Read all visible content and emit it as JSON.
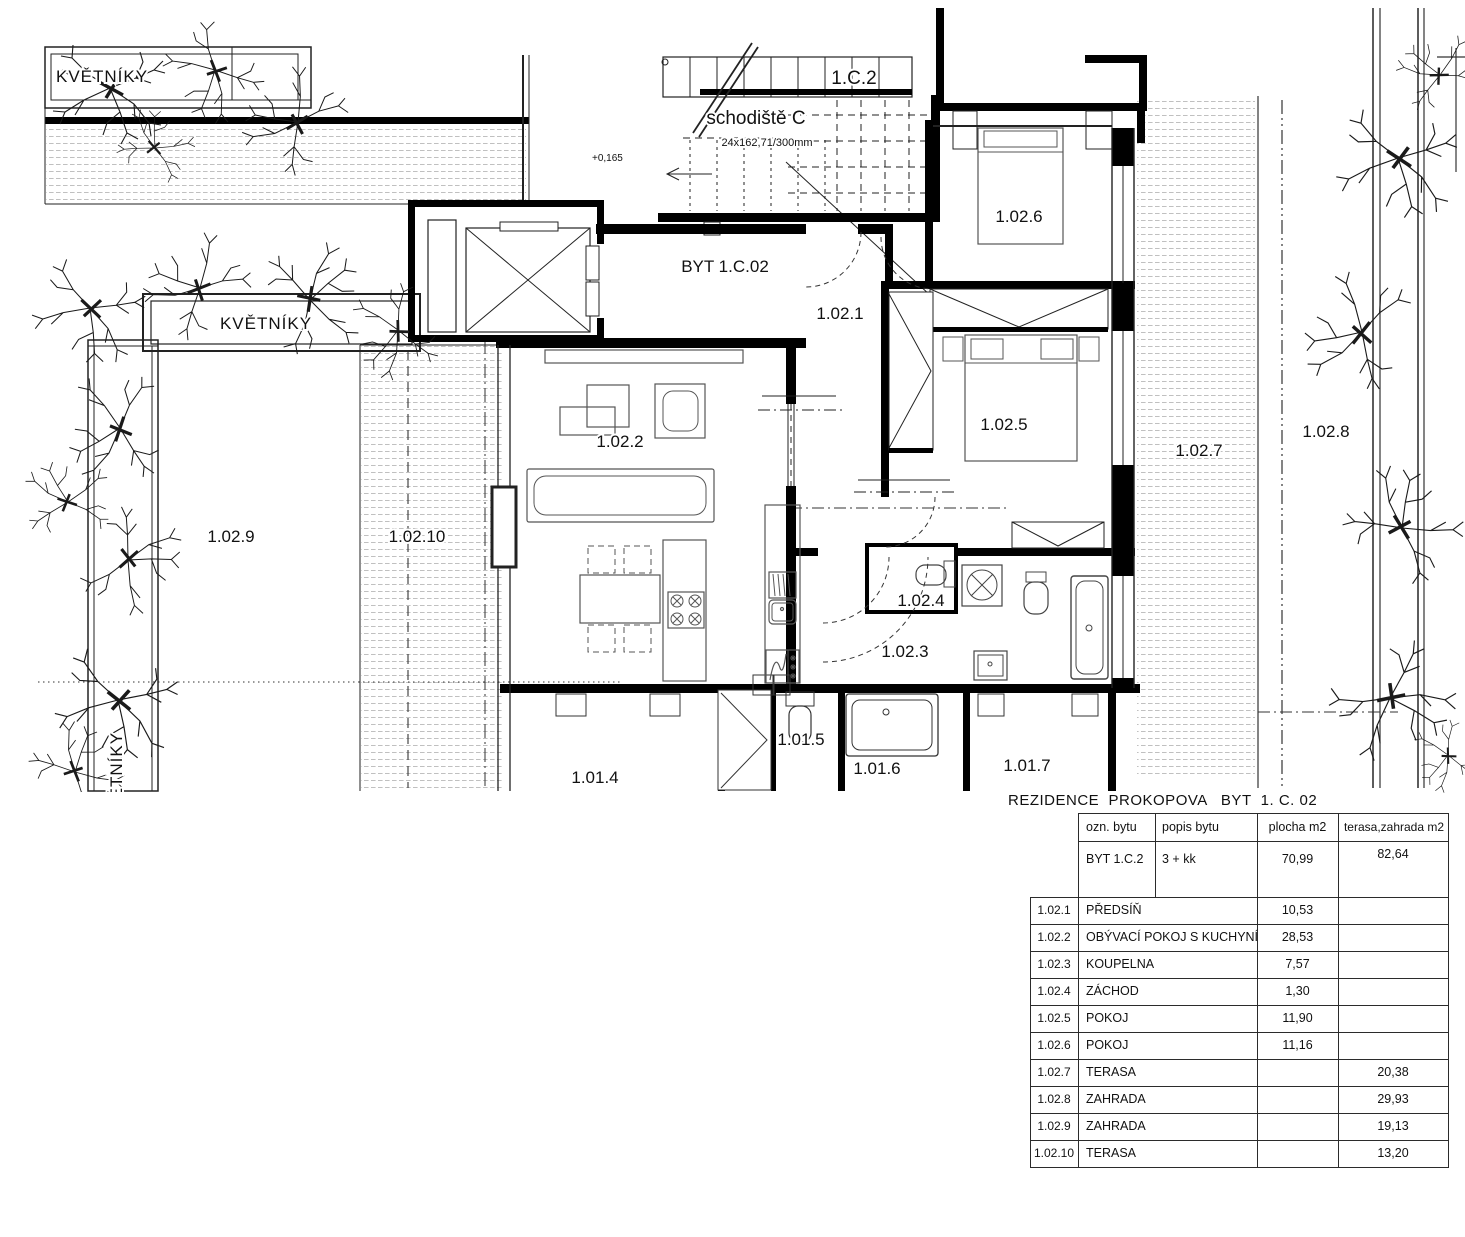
{
  "plan": {
    "unit_label": "BYT 1.C.02",
    "staircase": {
      "id": "1.C.2",
      "name": "schodiště C",
      "spec": "24x162,71/300mm",
      "level": "+0,165"
    },
    "planters": {
      "top": "KVĚTNÍKY",
      "middle": "KVĚTNÍKY",
      "left": "KVĚTNÍKY"
    },
    "rooms": {
      "r1021": "1.02.1",
      "r1022": "1.02.2",
      "r1023": "1.02.3",
      "r1024": "1.02.4",
      "r1025": "1.02.5",
      "r1026": "1.02.6",
      "r1027": "1.02.7",
      "r1028": "1.02.8",
      "r1029": "1.02.9",
      "r10210": "1.02.10"
    },
    "neighbor": {
      "r1014": "1.01.4",
      "r1015": "1.01.5",
      "r1016": "1.01.6",
      "r1017": "1.01.7"
    }
  },
  "table": {
    "title": "REZIDENCE  PROKOPOVA   BYT  1. C. 02",
    "headers": {
      "ozn": "ozn. bytu",
      "popis": "popis bytu",
      "plocha": "plocha m2",
      "terasa": "terasa,zahrada m2"
    },
    "summary": {
      "ozn": "BYT 1.C.2",
      "popis": "3 + kk",
      "plocha": "70,99",
      "terasa": "82,64"
    },
    "rows": [
      {
        "num": "1.02.1",
        "name": "PŘEDSÍŇ",
        "plocha": "10,53",
        "terasa": ""
      },
      {
        "num": "1.02.2",
        "name": "OBÝVACÍ POKOJ S KUCHYNÍ",
        "plocha": "28,53",
        "terasa": ""
      },
      {
        "num": "1.02.3",
        "name": "KOUPELNA",
        "plocha": "7,57",
        "terasa": ""
      },
      {
        "num": "1.02.4",
        "name": "ZÁCHOD",
        "plocha": "1,30",
        "terasa": ""
      },
      {
        "num": "1.02.5",
        "name": "POKOJ",
        "plocha": "11,90",
        "terasa": ""
      },
      {
        "num": "1.02.6",
        "name": "POKOJ",
        "plocha": "11,16",
        "terasa": ""
      },
      {
        "num": "1.02.7",
        "name": "TERASA",
        "plocha": "",
        "terasa": "20,38"
      },
      {
        "num": "1.02.8",
        "name": "ZAHRADA",
        "plocha": "",
        "terasa": "29,93"
      },
      {
        "num": "1.02.9",
        "name": "ZAHRADA",
        "plocha": "",
        "terasa": "19,13"
      },
      {
        "num": "1.02.10",
        "name": "TERASA",
        "plocha": "",
        "terasa": "13,20"
      }
    ]
  }
}
